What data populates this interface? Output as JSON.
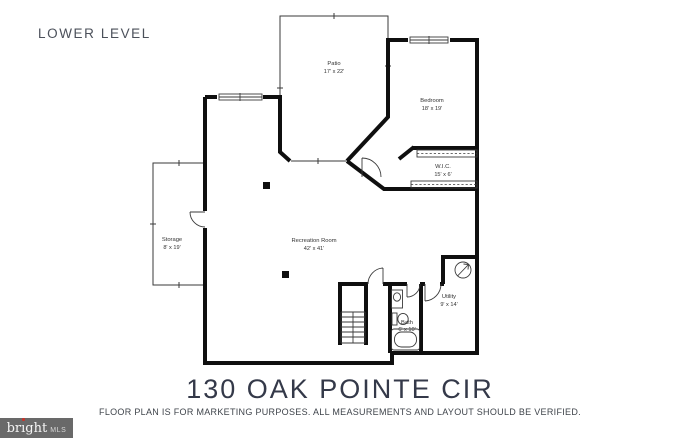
{
  "header": {
    "title": "LOWER LEVEL"
  },
  "rooms": [
    {
      "name": "Patio",
      "dims": "17' x 22'"
    },
    {
      "name": "Bedroom",
      "dims": "18' x 19'"
    },
    {
      "name": "W.I.C.",
      "dims": "15' x 6'"
    },
    {
      "name": "Storage",
      "dims": "8' x 19'"
    },
    {
      "name": "Recreation Room",
      "dims": "42' x 41'"
    },
    {
      "name": "Bath",
      "dims": "6' x 10'"
    },
    {
      "name": "Utility",
      "dims": "9' x 14'"
    }
  ],
  "footer": {
    "address": "130 OAK POINTE CIR",
    "disclaimer": "FLOOR PLAN IS FOR MARKETING PURPOSES. ALL MEASUREMENTS AND LAYOUT SHOULD BE VERIFIED."
  },
  "logo": {
    "pre": "br",
    "i": "ı",
    "post": "ght",
    "suffix": "MLS"
  },
  "colors": {
    "wall": "#0f0f0f",
    "thin_line": "#3a3a3a",
    "title_text": "#343949",
    "header_text": "#4b505a",
    "logo_background": "#696969",
    "logo_dot": "#c9342a",
    "background": "#ffffff"
  }
}
